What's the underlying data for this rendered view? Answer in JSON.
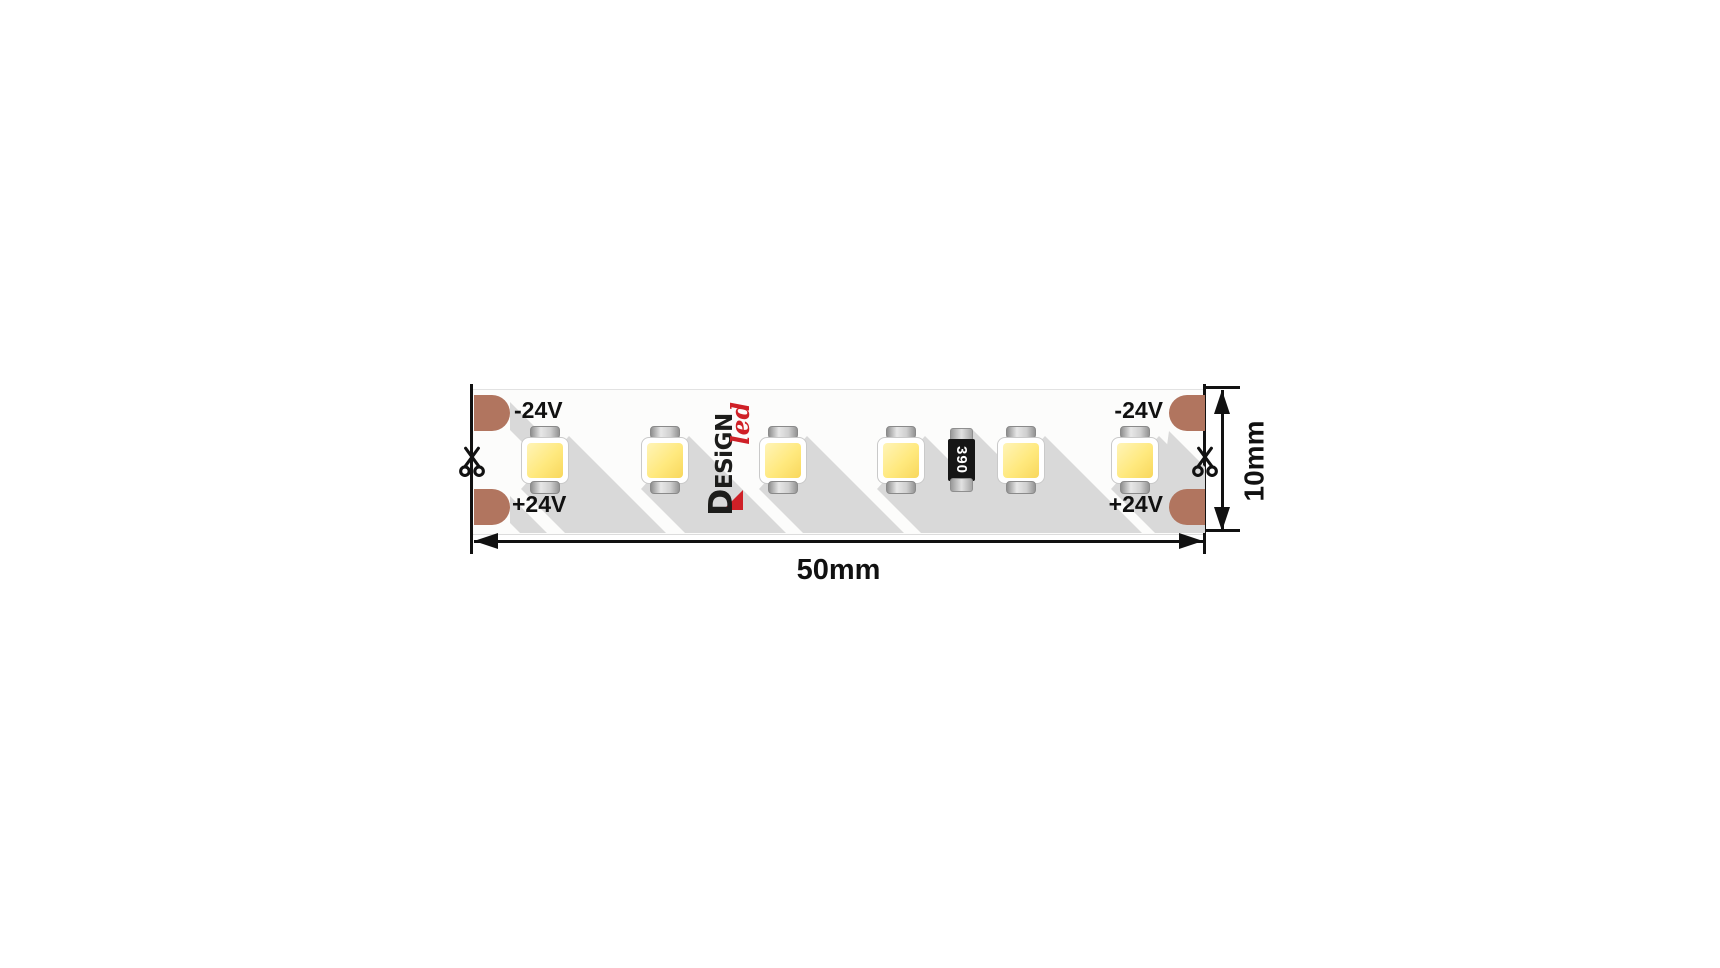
{
  "diagram": {
    "type": "led-strip-dimension-diagram",
    "terminals": {
      "left_negative": "-24V",
      "left_positive": "+24V",
      "right_negative": "-24V",
      "right_positive": "+24V"
    },
    "dimensions": {
      "width": "50mm",
      "height": "10mm"
    },
    "resistor_value": "390",
    "logo": {
      "text": "DESiGN",
      "accent": "led"
    },
    "led_count": 6,
    "icons": {
      "left_cut_marker": "scissors-icon",
      "right_cut_marker": "scissors-icon"
    },
    "colors": {
      "pad_copper": "#b1755f",
      "led_yellow": "#ffe97e",
      "logo_red": "#cf2027",
      "shadow_gray": "#d9d9d9",
      "line_black": "#111111",
      "strip_white": "#fcfcfb"
    }
  }
}
